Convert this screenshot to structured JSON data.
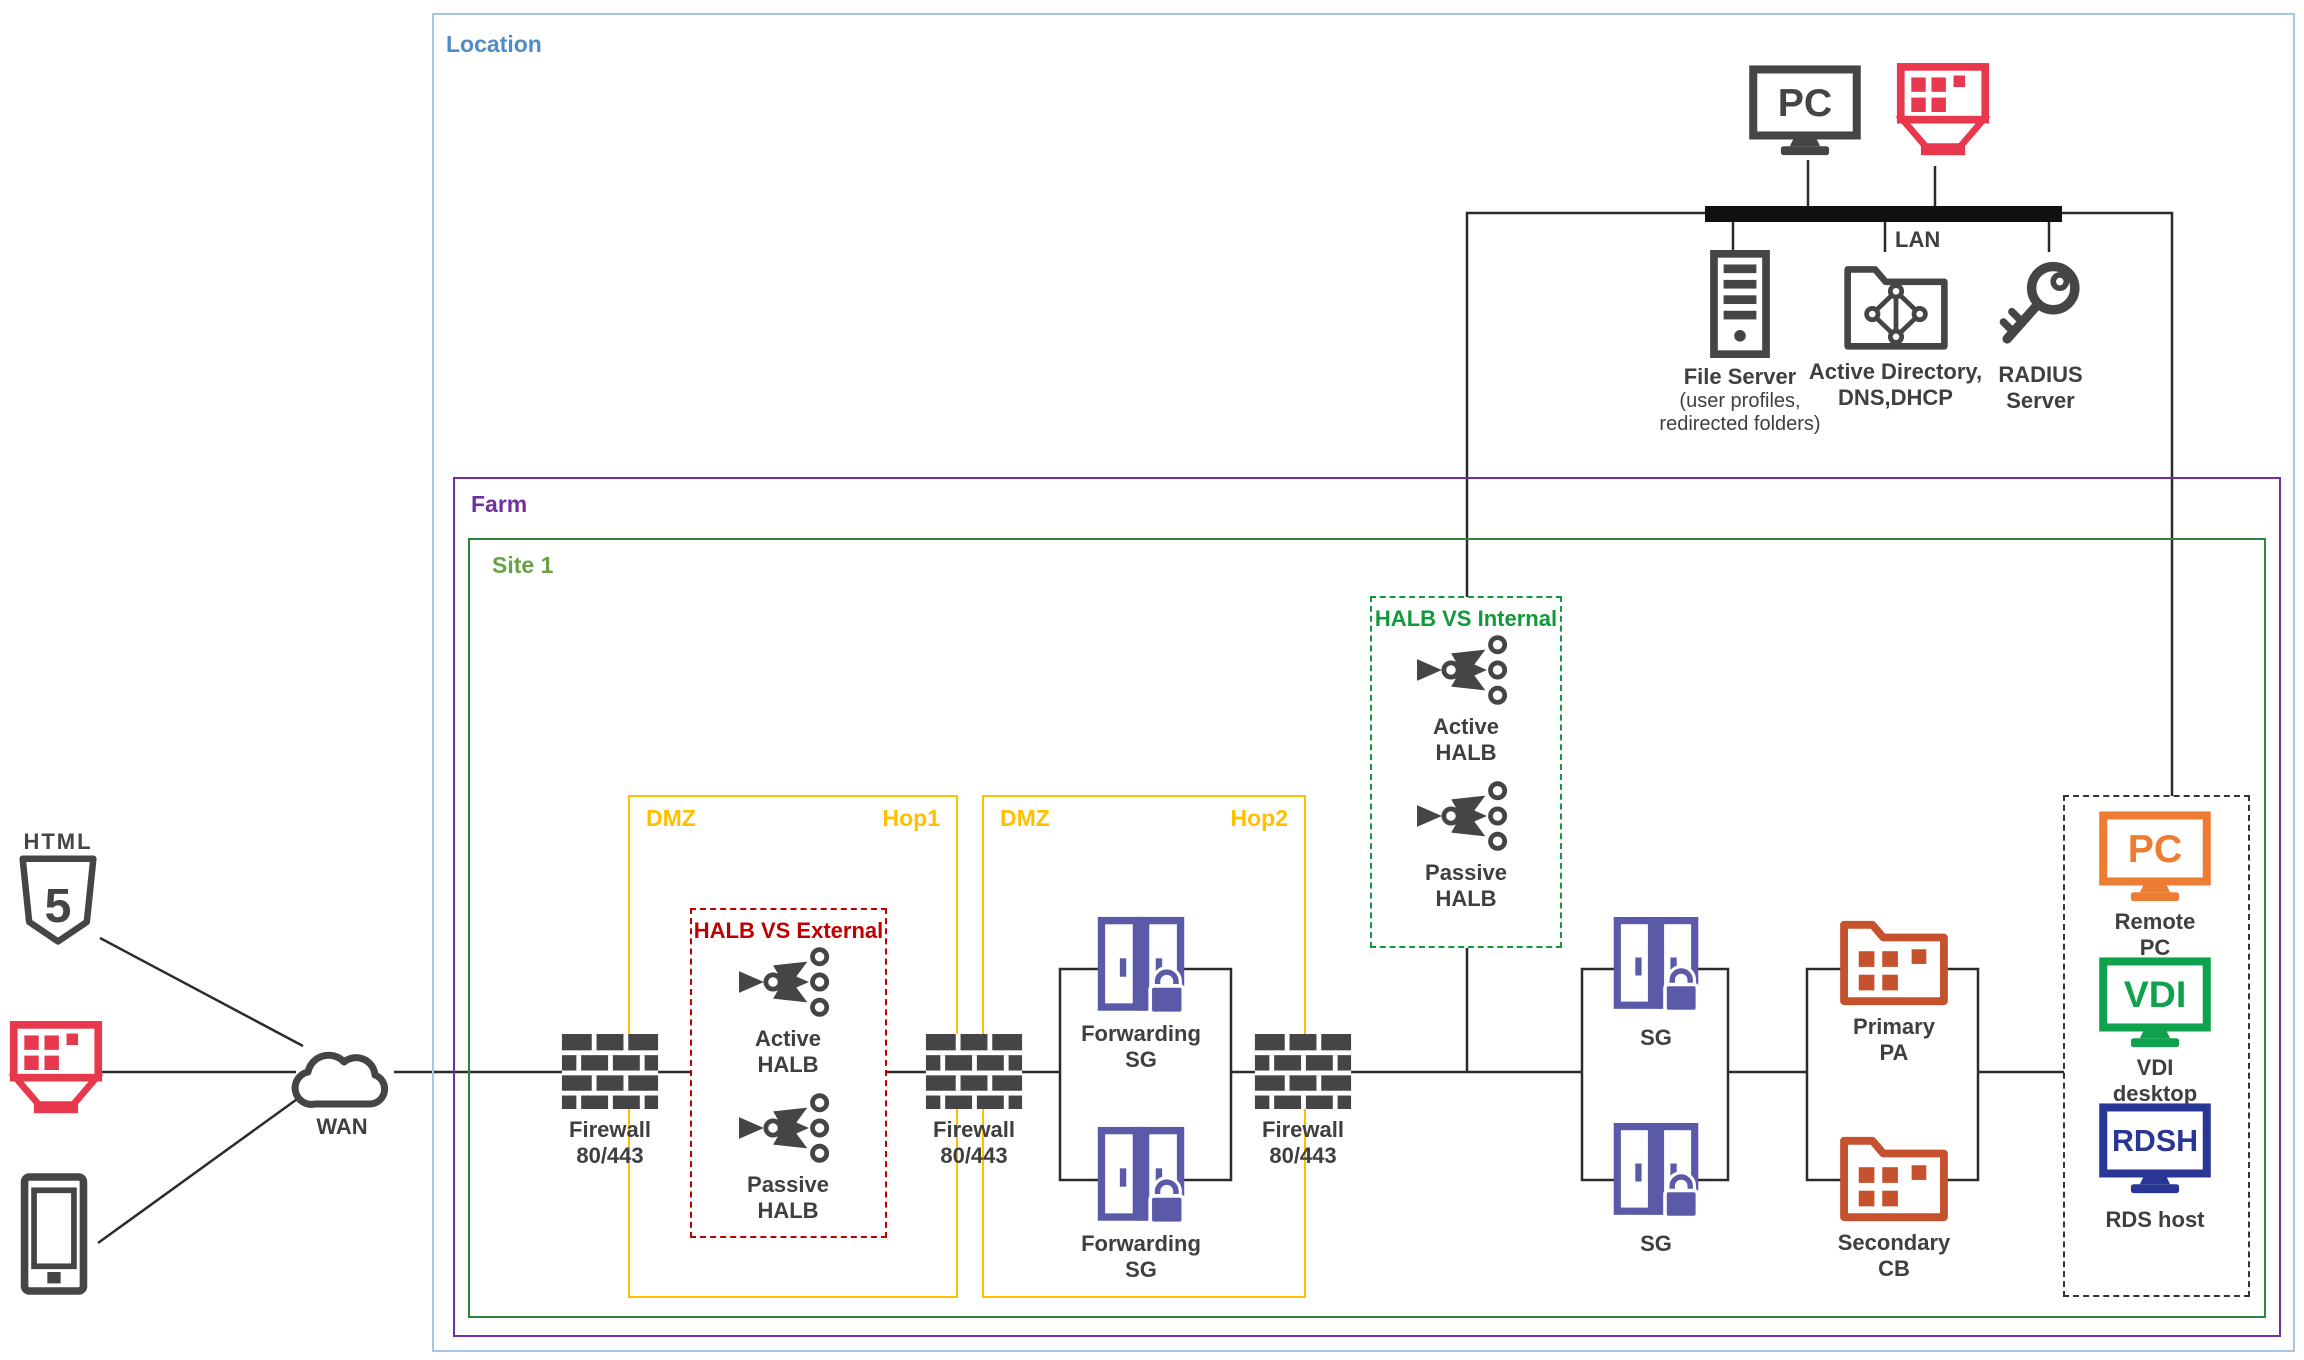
{
  "colors": {
    "location_border": "#A9C6E4",
    "location_label": "#4E8BC8",
    "farm": "#7030A0",
    "site_border": "#2E8540",
    "site_label": "#67A346",
    "dmz": "#FFC000",
    "halb_ext": "#C00000",
    "halb_int": "#12993B",
    "remote_border": "#333333",
    "icon_dark": "#454545",
    "label_dark": "#3F3F3F",
    "line": "#2B2B2B",
    "sg_purple": "#5A5AA8",
    "pa_orange": "#C5512D",
    "client_red": "#E8384E",
    "remote_pc_orange": "#EC7D33",
    "vdi_green": "#0FA24C",
    "rdsh_blue": "#2A3693"
  },
  "zones": {
    "location": "Location",
    "farm": "Farm",
    "site": "Site 1",
    "dmz1": {
      "zone": "DMZ",
      "hop": "Hop1"
    },
    "dmz2": {
      "zone": "DMZ",
      "hop": "Hop2"
    },
    "halb_external": "HALB VS External",
    "halb_internal": "HALB VS Internal"
  },
  "network": {
    "lan": "LAN",
    "wan": "WAN"
  },
  "clients": {
    "html5_badge": "HTML",
    "html5_digit": "5"
  },
  "office": {
    "pc_screen": "PC",
    "file_server_title": "File Server",
    "file_server_subtitle": "(user profiles,\nredirected folders)",
    "active_directory": "Active Directory,\nDNS,DHCP",
    "radius": "RADIUS\nServer"
  },
  "farm_nodes": {
    "firewall": "Firewall\n80/443",
    "active_halb": "Active\nHALB",
    "passive_halb": "Passive\nHALB",
    "forwarding_sg": "Forwarding\nSG",
    "sg": "SG",
    "primary_pa": "Primary\nPA",
    "secondary_cb": "Secondary\nCB"
  },
  "remote_hosts": {
    "pc_screen": "PC",
    "pc_label": "Remote\nPC",
    "vdi_screen": "VDI",
    "vdi_label": "VDI\ndesktop",
    "rdsh_screen": "RDSH",
    "rdsh_label": "RDS host"
  }
}
